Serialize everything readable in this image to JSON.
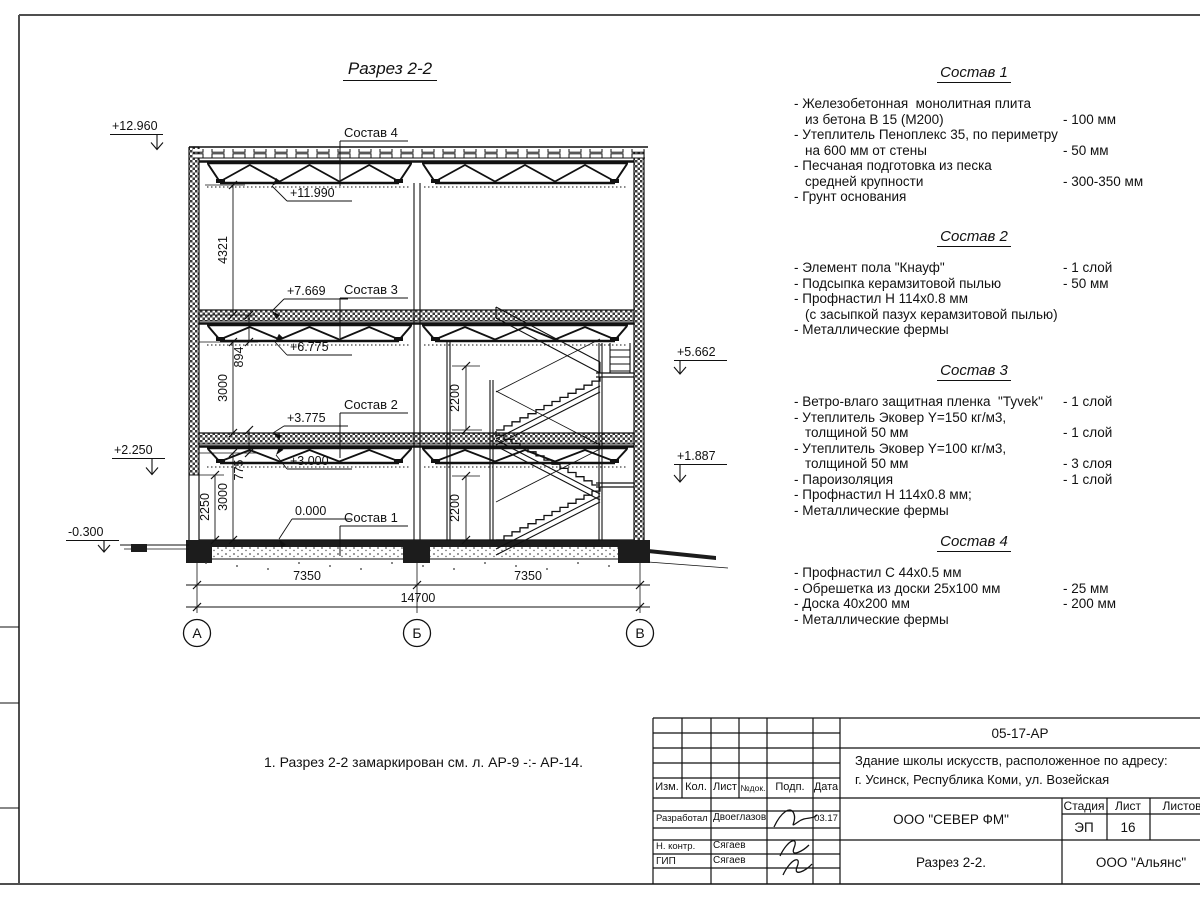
{
  "sheet": {
    "drawing_title": "Разрез 2-2",
    "note": "1. Разрез 2-2 замаркирован см. л. АР-9 -:- АР-14."
  },
  "section": {
    "elevations": {
      "roof_top": "+12.960",
      "roof_chord": "+11.990",
      "floor3_top": "+7.669",
      "floor3_chord": "+6.775",
      "landing2": "+5.662",
      "floor2_top": "+3.775",
      "floor2_chord": "+3.000",
      "plinth": "+2.250",
      "landing1": "+1.887",
      "ground": "0.000",
      "apron": "-0.300"
    },
    "dims": {
      "d4321": "4321",
      "d894": "894",
      "d3000a": "3000",
      "d775": "775",
      "d2250": "2250",
      "d3000b": "3000",
      "d2200a": "2200",
      "d2200b": "2200",
      "span_ab": "7350",
      "span_bv": "7350",
      "span_total": "14700"
    },
    "axes": [
      "А",
      "Б",
      "В"
    ],
    "callouts": {
      "c4": "Состав 4",
      "c3": "Состав 3",
      "c2": "Состав 2",
      "c1": "Состав 1"
    }
  },
  "compositions": [
    {
      "title": "Состав 1",
      "items": [
        {
          "lines": [
            "- Железобетонная  монолитная плита",
            "из бетона В 15 (М200)"
          ],
          "value": "- 100 мм"
        },
        {
          "lines": [
            "- Утеплитель Пеноплекс 35, по периметру",
            "на 600 мм от стены"
          ],
          "value": "- 50 мм"
        },
        {
          "lines": [
            "- Песчаная подготовка из песка",
            "средней крупности"
          ],
          "value": "- 300-350 мм"
        },
        {
          "lines": [
            "- Грунт основания"
          ],
          "value": ""
        }
      ]
    },
    {
      "title": "Состав 2",
      "items": [
        {
          "lines": [
            "- Элемент пола \"Кнауф\""
          ],
          "value": "- 1 слой"
        },
        {
          "lines": [
            "- Подсыпка керамзитовой пылью"
          ],
          "value": "- 50 мм"
        },
        {
          "lines": [
            "- Профнастил Н 114х0.8 мм",
            "(с засыпкой пазух керамзитовой пылью)"
          ],
          "value": ""
        },
        {
          "lines": [
            "- Металлические фермы"
          ],
          "value": ""
        }
      ]
    },
    {
      "title": "Состав 3",
      "items": [
        {
          "lines": [
            "- Ветро-влаго защитная пленка  \"Tyvek\""
          ],
          "value": "- 1 слой"
        },
        {
          "lines": [
            "- Утеплитель Эковер Y=150 кг/м3,",
            "толщиной 50 мм"
          ],
          "value": "- 1 слой"
        },
        {
          "lines": [
            "- Утеплитель Эковер Y=100 кг/м3,",
            "толщиной 50 мм"
          ],
          "value": "- 3 слоя"
        },
        {
          "lines": [
            "- Пароизоляция"
          ],
          "value": "- 1 слой"
        },
        {
          "lines": [
            "- Профнастил Н 114х0.8 мм;"
          ],
          "value": ""
        },
        {
          "lines": [
            "- Металлические фермы"
          ],
          "value": ""
        }
      ]
    },
    {
      "title": "Состав 4",
      "items": [
        {
          "lines": [
            "- Профнастил С 44х0.5 мм"
          ],
          "value": ""
        },
        {
          "lines": [
            "- Обрешетка из доски 25х100 мм"
          ],
          "value": "- 25 мм"
        },
        {
          "lines": [
            "- Доска 40х200 мм"
          ],
          "value": "- 200 мм"
        },
        {
          "lines": [
            "- Металлические фермы"
          ],
          "value": ""
        }
      ]
    }
  ],
  "titleblock": {
    "doc_number": "05-17-АР",
    "project_name_line1": "Здание школы искусств, расположенное по адресу:",
    "project_name_line2": "г. Усинск, Республика Коми, ул. Возейская",
    "organization": "ООО \"СЕВЕР ФМ\"",
    "sheet_title": "Разрез 2-2.",
    "contractor": "ООО \"Альянс\"",
    "stage_label": "Стадия",
    "sheet_label": "Лист",
    "sheets_label": "Листов",
    "stage": "ЭП",
    "sheet_number": "16",
    "cols": {
      "izm": "Изм.",
      "kol": "Кол.",
      "list": "Лист",
      "ndok": "№док.",
      "podp": "Подп.",
      "data": "Дата"
    },
    "rows": [
      {
        "role": "Разработал",
        "name": "Двоеглазов",
        "date": "03.17"
      },
      {
        "role": "Н. контр.",
        "name": "Сягаев",
        "date": ""
      },
      {
        "role": "ГИП",
        "name": "Сягаев",
        "date": ""
      }
    ]
  }
}
